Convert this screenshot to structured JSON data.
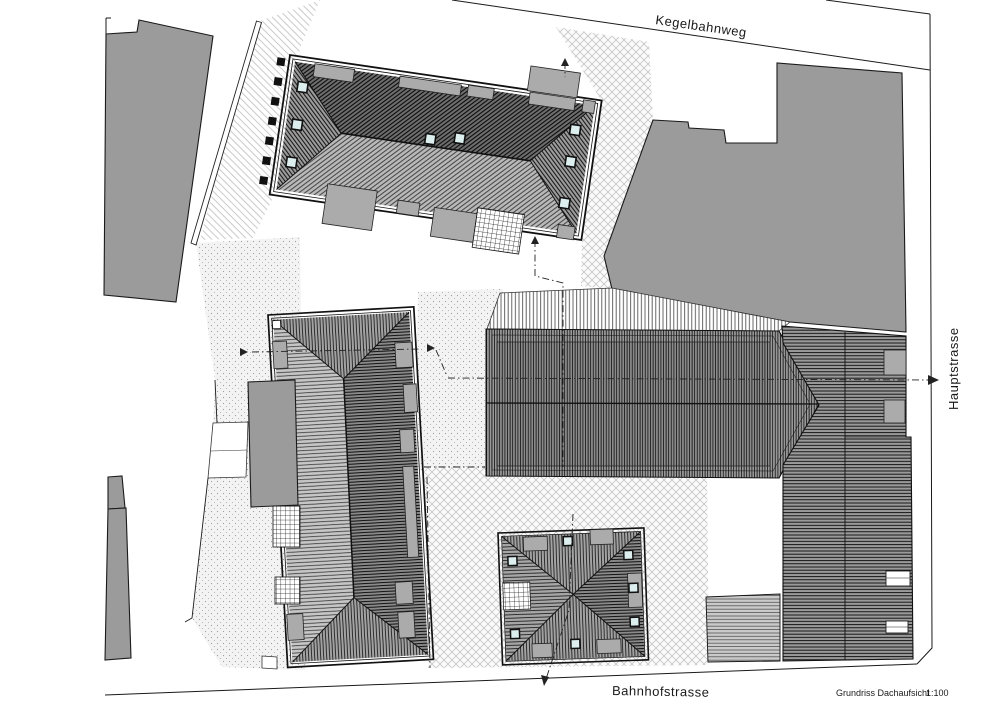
{
  "labels": {
    "street_top": "Kegelbahnweg",
    "street_right": "Hauptstrasse",
    "street_bottom": "Bahnhofstrasse",
    "drawing_title": "Grundriss Dachaufsicht",
    "drawing_scale": "1:100"
  },
  "colors": {
    "paper": "#ffffff",
    "line": "#1a1a1a",
    "neighbor_building_fill": "#9b9b9b",
    "dormer_fill": "#ababab",
    "skylight_fill": "#ddeeee",
    "dark_roof_hatch_bg": "#6e6e6e",
    "light_roof_hatch_bg": "#b9b9b9"
  }
}
